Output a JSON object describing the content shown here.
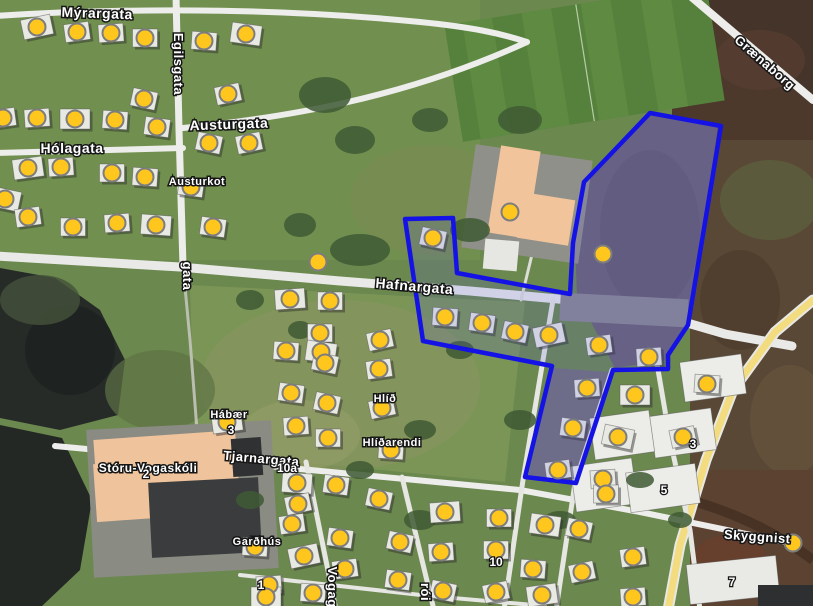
{
  "map": {
    "kind": "satellite-map-with-annotations",
    "street_labels": [
      {
        "text": "Mýrargata",
        "x": 97,
        "y": 18,
        "rot": 2,
        "size": 14
      },
      {
        "text": "Egilsgata",
        "x": 174,
        "y": 64,
        "rot": 90,
        "size": 13
      },
      {
        "text": "Austurgata",
        "x": 229,
        "y": 129,
        "rot": -2,
        "size": 14
      },
      {
        "text": "Hólagata",
        "x": 72,
        "y": 153,
        "rot": 0,
        "size": 14
      },
      {
        "text": "Austurkot",
        "x": 197,
        "y": 185,
        "rot": 0,
        "size": 11
      },
      {
        "text": "gata",
        "x": 183,
        "y": 276,
        "rot": 90,
        "size": 13
      },
      {
        "text": "Hafnargata",
        "x": 414,
        "y": 291,
        "rot": 5,
        "size": 14
      },
      {
        "text": "Grænaborg",
        "x": 762,
        "y": 66,
        "rot": 41,
        "size": 13
      },
      {
        "text": "Hábær",
        "x": 229,
        "y": 418,
        "rot": 0,
        "size": 11
      },
      {
        "text": "Hlíð",
        "x": 385,
        "y": 402,
        "rot": 0,
        "size": 11
      },
      {
        "text": "Hlíðarendi",
        "x": 392,
        "y": 446,
        "rot": 0,
        "size": 11
      },
      {
        "text": "Tjarnargata",
        "x": 261,
        "y": 463,
        "rot": 5,
        "size": 13
      },
      {
        "text": "Stóru-Vogaskóli",
        "x": 148,
        "y": 472,
        "rot": 0,
        "size": 12
      },
      {
        "text": "Garðhús",
        "x": 257,
        "y": 545,
        "rot": 0,
        "size": 11
      },
      {
        "text": "Vogagerði",
        "x": 328,
        "y": 600,
        "rot": 90,
        "size": 13
      },
      {
        "text": "rói",
        "x": 421,
        "y": 592,
        "rot": 90,
        "size": 13
      },
      {
        "text": "Skyggnist",
        "x": 757,
        "y": 541,
        "rot": 4,
        "size": 13
      }
    ],
    "house_number_labels": [
      {
        "text": "10a",
        "x": 287,
        "y": 472
      },
      {
        "text": "2",
        "x": 146,
        "y": 478
      },
      {
        "text": "3",
        "x": 231,
        "y": 434
      },
      {
        "text": "1",
        "x": 261,
        "y": 589
      },
      {
        "text": "10",
        "x": 496,
        "y": 566
      },
      {
        "text": "3",
        "x": 693,
        "y": 448
      },
      {
        "text": "5",
        "x": 664,
        "y": 494
      },
      {
        "text": "7",
        "x": 732,
        "y": 586
      }
    ],
    "markers": {
      "color": "#FFC61E",
      "border": "#7D7D7D",
      "points": [
        [
          37,
          27
        ],
        [
          77,
          32
        ],
        [
          111,
          33
        ],
        [
          145,
          38
        ],
        [
          204,
          41
        ],
        [
          246,
          34
        ],
        [
          144,
          99
        ],
        [
          228,
          94
        ],
        [
          3,
          118
        ],
        [
          37,
          118
        ],
        [
          75,
          119
        ],
        [
          115,
          120
        ],
        [
          157,
          127
        ],
        [
          209,
          143
        ],
        [
          249,
          143
        ],
        [
          28,
          168
        ],
        [
          61,
          167
        ],
        [
          112,
          173
        ],
        [
          145,
          177
        ],
        [
          191,
          187
        ],
        [
          5,
          199
        ],
        [
          510,
          212
        ],
        [
          28,
          217
        ],
        [
          117,
          223
        ],
        [
          73,
          227
        ],
        [
          156,
          225
        ],
        [
          213,
          227
        ],
        [
          433,
          238
        ],
        [
          603,
          254
        ],
        [
          318,
          262
        ],
        [
          290,
          299
        ],
        [
          330,
          301
        ],
        [
          445,
          317
        ],
        [
          482,
          323
        ],
        [
          515,
          332
        ],
        [
          549,
          335
        ],
        [
          599,
          345
        ],
        [
          649,
          357
        ],
        [
          320,
          333
        ],
        [
          286,
          351
        ],
        [
          321,
          352
        ],
        [
          325,
          363
        ],
        [
          380,
          340
        ],
        [
          379,
          369
        ],
        [
          587,
          388
        ],
        [
          635,
          395
        ],
        [
          707,
          384
        ],
        [
          291,
          393
        ],
        [
          327,
          403
        ],
        [
          382,
          408
        ],
        [
          227,
          422
        ],
        [
          296,
          426
        ],
        [
          328,
          438
        ],
        [
          391,
          450
        ],
        [
          573,
          428
        ],
        [
          618,
          437
        ],
        [
          683,
          437
        ],
        [
          558,
          470
        ],
        [
          603,
          479
        ],
        [
          606,
          494
        ],
        [
          297,
          483
        ],
        [
          336,
          485
        ],
        [
          379,
          499
        ],
        [
          298,
          504
        ],
        [
          292,
          524
        ],
        [
          445,
          512
        ],
        [
          499,
          518
        ],
        [
          255,
          547
        ],
        [
          340,
          538
        ],
        [
          400,
          542
        ],
        [
          304,
          556
        ],
        [
          345,
          569
        ],
        [
          441,
          552
        ],
        [
          496,
          550
        ],
        [
          533,
          569
        ],
        [
          545,
          525
        ],
        [
          579,
          529
        ],
        [
          582,
          572
        ],
        [
          633,
          557
        ],
        [
          269,
          585
        ],
        [
          266,
          597
        ],
        [
          313,
          593
        ],
        [
          398,
          580
        ],
        [
          443,
          591
        ],
        [
          496,
          592
        ],
        [
          542,
          595
        ],
        [
          633,
          597
        ],
        [
          793,
          543
        ]
      ],
      "no_house_under": [
        "318,262",
        "603,254",
        "510,212",
        "793,543"
      ]
    },
    "selection_polygon": {
      "stroke": "#1512E6",
      "fill": "rgba(90,90,230,0.16)",
      "points": [
        [
          650,
          113
        ],
        [
          721,
          126
        ],
        [
          688,
          325
        ],
        [
          668,
          355
        ],
        [
          668,
          369
        ],
        [
          613,
          370
        ],
        [
          576,
          483
        ],
        [
          525,
          477
        ],
        [
          552,
          366
        ],
        [
          423,
          341
        ],
        [
          405,
          219
        ],
        [
          453,
          218
        ],
        [
          457,
          273
        ],
        [
          570,
          294
        ],
        [
          573,
          243
        ],
        [
          584,
          182
        ]
      ]
    }
  }
}
